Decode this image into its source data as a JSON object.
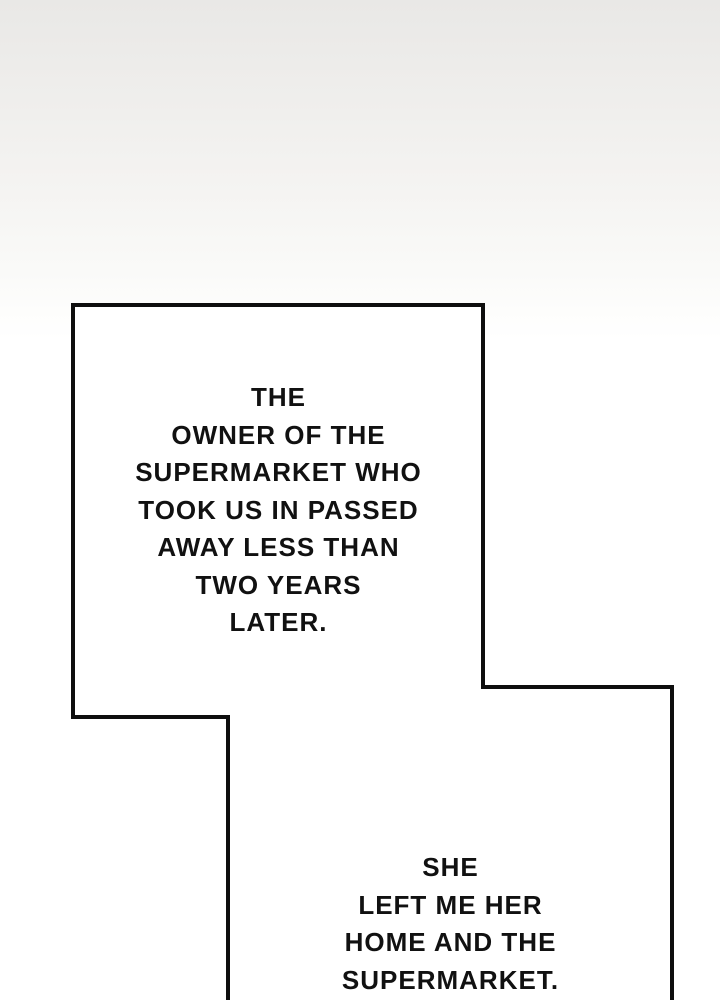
{
  "colors": {
    "bg_top": "#e9e8e6",
    "bg_mid": "#f4f3f1",
    "bg_bottom": "#ffffff",
    "panel_fill": "#ffffff",
    "panel_border": "#0e0e0e",
    "text_color": "#111111"
  },
  "narration": {
    "box1_text": "THE\nOWNER OF THE\nSUPERMARKET WHO\nTOOK US IN PASSED\nAWAY LESS THAN\nTWO YEARS\nLATER.",
    "box2_text": "SHE\nLEFT ME HER\nHOME AND THE\nSUPERMARKET."
  }
}
